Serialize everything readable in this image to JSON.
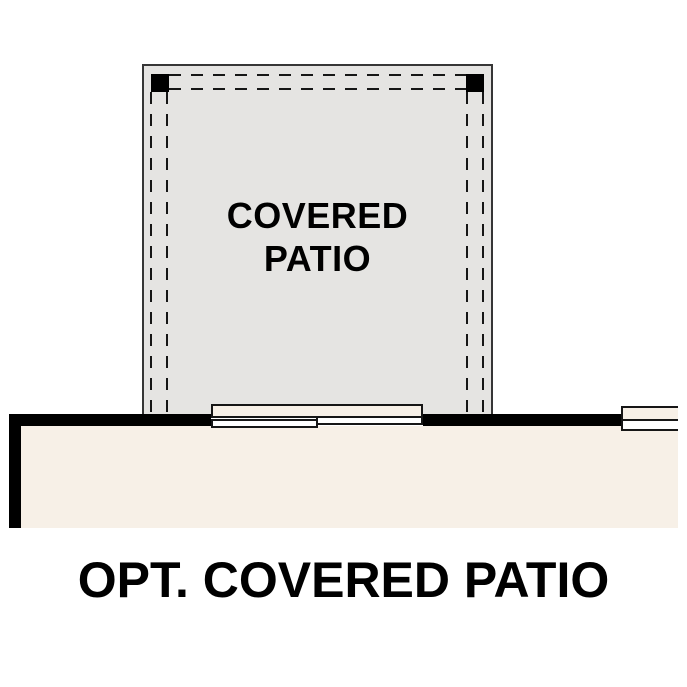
{
  "plan": {
    "patio_label": {
      "line1": "COVERED",
      "line2": "PATIO"
    },
    "title": "OPT. COVERED PATIO"
  },
  "colors": {
    "background": "#ffffff",
    "patio_fill": "#e5e4e2",
    "patio_border": "#363636",
    "house_fill": "#f7f0e7",
    "wall": "#000000",
    "line": "#161616",
    "text": "#000000"
  }
}
